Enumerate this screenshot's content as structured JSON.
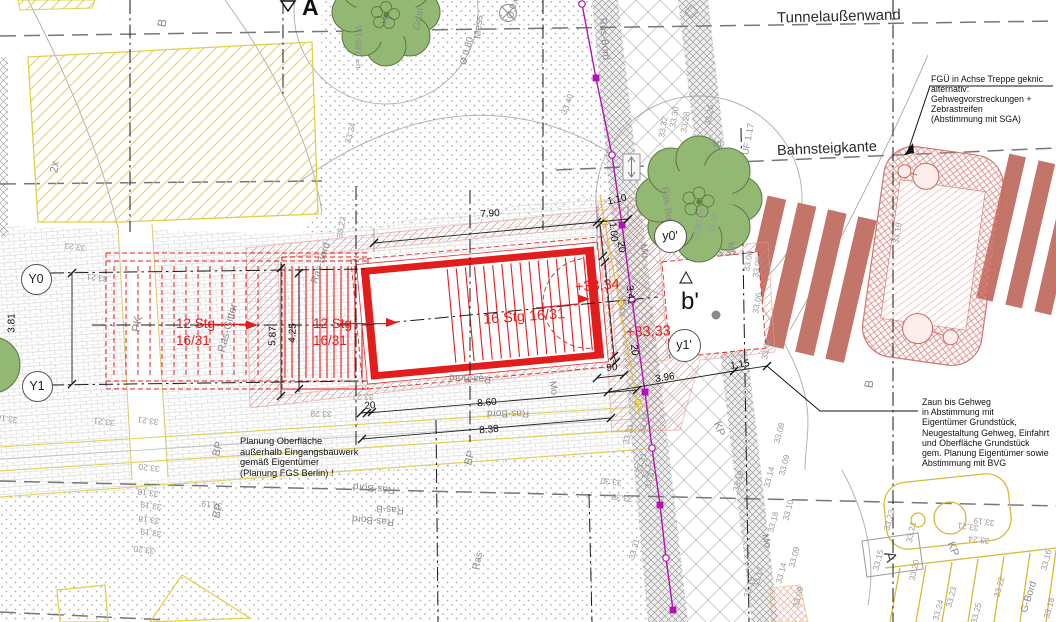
{
  "titles": {
    "tunnel_wall": "Tunnelaußenwand",
    "platform_edge": "Bahnsteigkante"
  },
  "notes": {
    "fgue": "FGÜ in Achse Treppe geknic\nalternativ:\nGehwegvorstreckungen +\nZebrastreifen\n(Abstimmung mit SGA)",
    "zaun": "Zaun bis Gehweg\nin Abstimmung mit\nEigentümer Grundstück,\nNeugestaltung Gehweg, Einfahrt\nund Oberfläche Grundstück\ngem. Planung Eigentümer sowie\nAbstimmung mit BVG",
    "planung": "Planung Oberfläche\naußerhalb Eingangsbauwerk\ngemäß Eigentümer\n(Planung FGS Berlin) !"
  },
  "stair": {
    "run_left": "12 Stg\n16/31",
    "run_mid": "12 Stg\n16/31",
    "run_main": "16 Stg 16/31",
    "level_top": "+33,34",
    "level_street": "+33,33"
  },
  "section_markers": {
    "a_top": "A",
    "a_bottom": "A",
    "b_prime": "b'"
  },
  "axis_circles": [
    {
      "label": "Y0",
      "x": 36,
      "y": 279,
      "d": 31
    },
    {
      "label": "Y1",
      "x": 37,
      "y": 386,
      "d": 31
    },
    {
      "label": "y0'",
      "x": 670,
      "y": 236,
      "d": 33
    },
    {
      "label": "y1'",
      "x": 684,
      "y": 345,
      "d": 33
    }
  ],
  "dimensions": [
    {
      "t": "7.90",
      "x": 490,
      "y": 214,
      "r": -4
    },
    {
      "t": "1.10",
      "x": 617,
      "y": 200,
      "r": -12
    },
    {
      "t": "1.00",
      "x": 613,
      "y": 232,
      "r": 84
    },
    {
      "t": "20",
      "x": 621,
      "y": 247,
      "r": 84
    },
    {
      "t": "3.41",
      "x": 630,
      "y": 295,
      "r": 84
    },
    {
      "t": "20",
      "x": 634,
      "y": 350,
      "r": 84
    },
    {
      "t": "90",
      "x": 612,
      "y": 368,
      "r": -5
    },
    {
      "t": "3.96",
      "x": 665,
      "y": 378,
      "r": -9
    },
    {
      "t": "1.15",
      "x": 740,
      "y": 365,
      "r": -9
    },
    {
      "t": "8.60",
      "x": 487,
      "y": 403,
      "r": -5
    },
    {
      "t": "8.38",
      "x": 489,
      "y": 430,
      "r": -5
    },
    {
      "t": "5.87",
      "x": 273,
      "y": 336,
      "r": -88
    },
    {
      "t": "4.25",
      "x": 293,
      "y": 333,
      "r": -88
    },
    {
      "t": "3.81",
      "x": 12,
      "y": 323,
      "r": -90
    },
    {
      "t": "20",
      "x": 370,
      "y": 406,
      "r": -4
    }
  ],
  "elevations": [
    {
      "t": "33.23",
      "x": 75,
      "y": 247,
      "r": 187
    },
    {
      "t": "33.21",
      "x": 97,
      "y": 278,
      "r": 187
    },
    {
      "t": "33.22",
      "x": 341,
      "y": 227,
      "r": -80
    },
    {
      "t": "33.24",
      "x": 350,
      "y": 133,
      "r": -75
    },
    {
      "t": "33.40",
      "x": 567,
      "y": 104,
      "r": -70
    },
    {
      "t": "33.32",
      "x": 663,
      "y": 127,
      "r": -80
    },
    {
      "t": "33.30",
      "x": 674,
      "y": 117,
      "r": -80
    },
    {
      "t": "33.28",
      "x": 685,
      "y": 122,
      "r": -80
    },
    {
      "t": "33.26",
      "x": 709,
      "y": 115,
      "r": -80
    },
    {
      "t": "33.28",
      "x": 700,
      "y": 219,
      "r": -78
    },
    {
      "t": "33.30",
      "x": 697,
      "y": 231,
      "r": -78
    },
    {
      "t": "33.28",
      "x": 713,
      "y": 223,
      "r": -78
    },
    {
      "t": "33.06",
      "x": 748,
      "y": 261,
      "r": -80
    },
    {
      "t": "33.08",
      "x": 757,
      "y": 267,
      "r": -80
    },
    {
      "t": "33.06",
      "x": 757,
      "y": 303,
      "r": -80
    },
    {
      "t": "33.07",
      "x": 766,
      "y": 349,
      "r": -80
    },
    {
      "t": "33.19",
      "x": 897,
      "y": 233,
      "r": -80
    },
    {
      "t": "33.30",
      "x": 623,
      "y": 306,
      "r": -80
    },
    {
      "t": "33.31",
      "x": 628,
      "y": 434,
      "r": -75
    },
    {
      "t": "33.28",
      "x": 644,
      "y": 423,
      "r": -75
    },
    {
      "t": "33.31",
      "x": 641,
      "y": 463,
      "r": -75
    },
    {
      "t": "33.12",
      "x": 647,
      "y": 469,
      "r": -75
    },
    {
      "t": "33.31",
      "x": 650,
      "y": 478,
      "r": -75
    },
    {
      "t": "33.30",
      "x": 611,
      "y": 482,
      "r": 186
    },
    {
      "t": "33.30",
      "x": 622,
      "y": 498,
      "r": 186
    },
    {
      "t": "33.31",
      "x": 634,
      "y": 549,
      "r": -75
    },
    {
      "t": "33.19",
      "x": 738,
      "y": 481,
      "r": -75
    },
    {
      "t": "33.08",
      "x": 779,
      "y": 433,
      "r": -75
    },
    {
      "t": "33.09",
      "x": 784,
      "y": 465,
      "r": -75
    },
    {
      "t": "33.14",
      "x": 769,
      "y": 477,
      "r": -75
    },
    {
      "t": "33.10",
      "x": 788,
      "y": 510,
      "r": -75
    },
    {
      "t": "33.18",
      "x": 773,
      "y": 522,
      "r": -75
    },
    {
      "t": "33.09",
      "x": 794,
      "y": 557,
      "r": -75
    },
    {
      "t": "33.14",
      "x": 781,
      "y": 573,
      "r": -75
    },
    {
      "t": "33.17",
      "x": 758,
      "y": 577,
      "r": -75
    },
    {
      "t": "33.19",
      "x": 749,
      "y": 587,
      "r": -75
    },
    {
      "t": "33.09",
      "x": 798,
      "y": 597,
      "r": -75
    },
    {
      "t": "33.15",
      "x": 878,
      "y": 560,
      "r": -75
    },
    {
      "t": "33.22",
      "x": 889,
      "y": 520,
      "r": -75
    },
    {
      "t": "33.21",
      "x": 911,
      "y": 532,
      "r": -78
    },
    {
      "t": "33.20",
      "x": 914,
      "y": 570,
      "r": -78
    },
    {
      "t": "33.23",
      "x": 951,
      "y": 597,
      "r": -75
    },
    {
      "t": "33.24",
      "x": 938,
      "y": 610,
      "r": -75
    },
    {
      "t": "33.21",
      "x": 968,
      "y": 527,
      "r": 187
    },
    {
      "t": "33.19",
      "x": 984,
      "y": 522,
      "r": 187
    },
    {
      "t": "33.24",
      "x": 979,
      "y": 540,
      "r": 187
    },
    {
      "t": "33.25",
      "x": 976,
      "y": 613,
      "r": -75
    },
    {
      "t": "33.22",
      "x": 999,
      "y": 587,
      "r": -75
    },
    {
      "t": "33.16",
      "x": 1046,
      "y": 560,
      "r": -75
    },
    {
      "t": "33.18",
      "x": 1049,
      "y": 608,
      "r": -75
    },
    {
      "t": "33.18",
      "x": 7,
      "y": 419,
      "r": 187
    },
    {
      "t": "33.21",
      "x": 104,
      "y": 422,
      "r": 187
    },
    {
      "t": "33.21",
      "x": 148,
      "y": 421,
      "r": 187
    },
    {
      "t": "33.20",
      "x": 149,
      "y": 468,
      "r": 187
    },
    {
      "t": "33.18",
      "x": 148,
      "y": 493,
      "r": 187
    },
    {
      "t": "33.19",
      "x": 151,
      "y": 506,
      "r": 187
    },
    {
      "t": "33.18",
      "x": 149,
      "y": 520,
      "r": 187
    },
    {
      "t": "33.19",
      "x": 151,
      "y": 533,
      "r": 187
    },
    {
      "t": "33.20",
      "x": 144,
      "y": 550,
      "r": 187
    },
    {
      "t": "33.27",
      "x": 363,
      "y": 397,
      "r": 182
    },
    {
      "t": "33.28",
      "x": 321,
      "y": 414,
      "r": 182
    },
    {
      "t": "33.19",
      "x": 212,
      "y": 505,
      "r": 187
    }
  ],
  "surface_labels": [
    {
      "t": "B",
      "x": 162,
      "y": 23,
      "r": -80,
      "s": 12
    },
    {
      "t": "B",
      "x": 869,
      "y": 384,
      "r": -80,
      "s": 12
    },
    {
      "t": "2x",
      "x": 55,
      "y": 167,
      "r": -80,
      "s": 11
    },
    {
      "t": "u= 0,89-1,5",
      "x": 358,
      "y": 47,
      "r": -88,
      "s": 8.5
    },
    {
      "t": "1x",
      "x": 384,
      "y": 21,
      "r": -75,
      "s": 9
    },
    {
      "t": "Grün",
      "x": 419,
      "y": 19,
      "r": -80,
      "s": 10
    },
    {
      "t": "Mess",
      "x": 479,
      "y": 27,
      "r": -85,
      "s": 10
    },
    {
      "t": "Ø 0,80",
      "x": 467,
      "y": 51,
      "r": -75,
      "s": 9.5
    },
    {
      "t": "Ø 0,60",
      "x": 514,
      "y": 5,
      "r": -75,
      "s": 9.5
    },
    {
      "t": "Ras-Bord",
      "x": 604,
      "y": 39,
      "r": 85,
      "s": 10
    },
    {
      "t": "Ras-Bord",
      "x": 667,
      "y": 208,
      "r": 82,
      "s": 10
    },
    {
      "t": "Ras-Bord",
      "x": 321,
      "y": 263,
      "r": -72,
      "s": 10
    },
    {
      "t": "Ras-Gitter",
      "x": 228,
      "y": 328,
      "r": -75,
      "s": 11
    },
    {
      "t": "PK",
      "x": 137,
      "y": 324,
      "r": -80,
      "s": 12
    },
    {
      "t": "Ras-Bord",
      "x": 470,
      "y": 378,
      "r": 183,
      "s": 10
    },
    {
      "t": "Ras-Bord",
      "x": 508,
      "y": 413,
      "r": 180,
      "s": 10
    },
    {
      "t": "Ras-Bord",
      "x": 374,
      "y": 488,
      "r": 185,
      "s": 10
    },
    {
      "t": "Ras-Bord",
      "x": 373,
      "y": 520,
      "r": 185,
      "s": 10
    },
    {
      "t": "Ras-B",
      "x": 390,
      "y": 509,
      "r": 185,
      "s": 10
    },
    {
      "t": "BP",
      "x": 218,
      "y": 449,
      "r": -75,
      "s": 11
    },
    {
      "t": "BP",
      "x": 218,
      "y": 511,
      "r": -75,
      "s": 11
    },
    {
      "t": "BP",
      "x": 470,
      "y": 458,
      "r": -75,
      "s": 11
    },
    {
      "t": "Mo",
      "x": 553,
      "y": 388,
      "r": 80,
      "s": 10
    },
    {
      "t": "Mo",
      "x": 644,
      "y": 251,
      "r": 80,
      "s": 10
    },
    {
      "t": "Mo",
      "x": 731,
      "y": 249,
      "r": 80,
      "s": 10
    },
    {
      "t": "Mo",
      "x": 766,
      "y": 541,
      "r": 75,
      "s": 10
    },
    {
      "t": "KP",
      "x": 719,
      "y": 429,
      "r": 70,
      "s": 11
    },
    {
      "t": "KP",
      "x": 953,
      "y": 549,
      "r": 70,
      "s": 11
    },
    {
      "t": "S",
      "x": 718,
      "y": 144,
      "r": -80,
      "s": 11
    },
    {
      "t": "UF 1.17",
      "x": 748,
      "y": 139,
      "r": -80,
      "s": 9
    },
    {
      "t": "Ras",
      "x": 478,
      "y": 561,
      "r": -78,
      "s": 10
    },
    {
      "t": "G-Bord",
      "x": 1029,
      "y": 597,
      "r": -72,
      "s": 10
    }
  ]
}
